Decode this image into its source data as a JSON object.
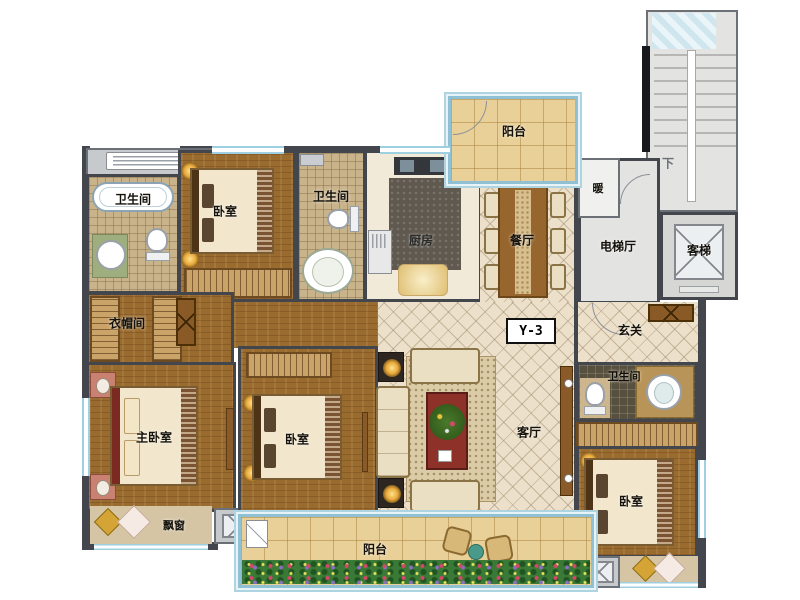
{
  "unit": {
    "label": "Y-3",
    "stairs_direction": "下"
  },
  "rooms": {
    "bath_top_left": "卫生间",
    "bedroom_top_left": "卧室",
    "cloakroom": "衣帽间",
    "bath_top_mid": "卫生间",
    "kitchen": "厨房",
    "balcony_top": "阳台",
    "dining": "餐厅",
    "heating": "暖",
    "elevator_hall": "电梯厅",
    "elevator": "客梯",
    "foyer": "玄关",
    "living": "客厅",
    "master_bedroom": "主卧室",
    "bay_window": "飘窗",
    "bedroom_mid": "卧室",
    "bath_right": "卫生间",
    "bedroom_right": "卧室",
    "balcony_bottom": "阳台"
  },
  "colors": {
    "wall": "#43474d",
    "wall_black": "#17191c",
    "window_blue": "#9fd0e2",
    "wood_floor": "#9a6b2f",
    "tile_floor": "#ece0ca",
    "balcony_floor": "#e9d098",
    "gray_area": "#e3e3e1",
    "accent_table": "#8e3128"
  }
}
